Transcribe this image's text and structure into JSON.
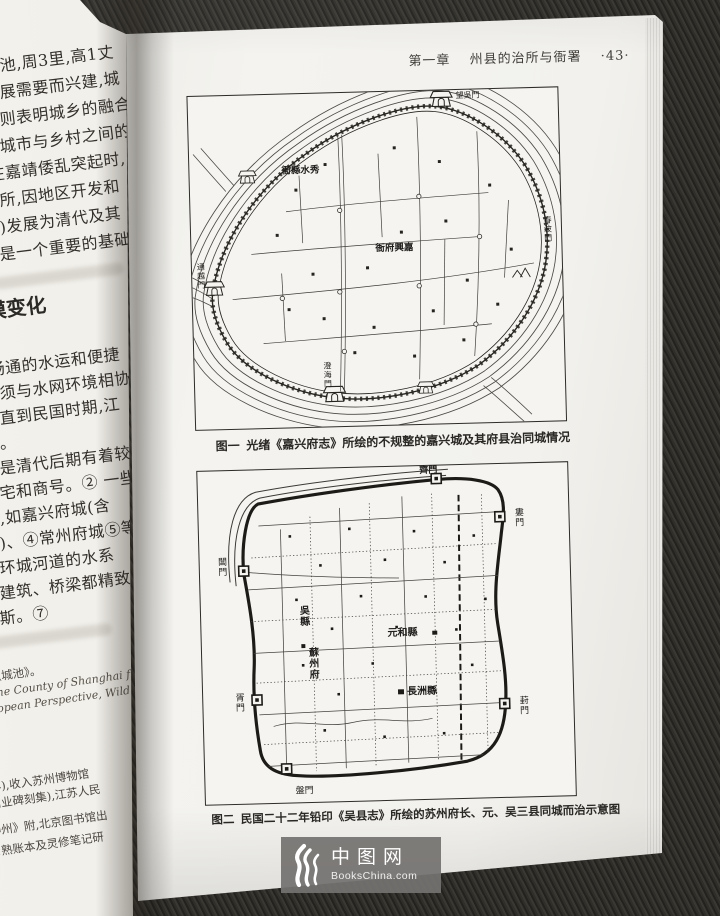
{
  "page": {
    "header": {
      "chapter": "第一章",
      "title": "州县的治所与衙署",
      "page_no": "·43·"
    },
    "figure1": {
      "tag": "图一",
      "caption": "光绪《嘉兴府志》所绘的不规整的嘉兴城及其府县治同城情况",
      "labels": {
        "xiushui_yamen": "衙縣水秀",
        "jiaxing_yamen": "衙府興嘉",
        "gate_north": "望吳門",
        "gate_west": "通越門",
        "gate_east": "春波門",
        "gate_south": "澄海門"
      }
    },
    "figure2": {
      "tag": "图二",
      "caption": "民国二十二年铅印《吴县志》所绘的苏州府长、元、吴三县同城而治示意图",
      "labels": {
        "gate_north": "齊門",
        "gate_northeast": "婁門",
        "gate_east": "葑門",
        "gate_south": "盤門",
        "gate_southwest": "胥門",
        "gate_west": "閶門",
        "wu_county": "吳縣",
        "suzhou_fu": "蘇州府",
        "yuanhe_county": "元和縣",
        "changzhou_county": "長洲縣"
      }
    }
  },
  "left_page": {
    "para1_lines": [
      "筑城池,周3里,高1丈",
      "的发展需要而兴建,城",
      "方面则表明城乡的融合",
      "和大城市与乡村之间的",
      "性,在嘉靖倭乱突起时,",
      "政驻所,因地区开发和",
      "卫等)发展为清代及其",
      "应当是一个重要的基础"
    ],
    "heading": "模变化",
    "para2_lines": [
      "上,畅通的水运和便捷",
      "态必须与水网环境相协",
      "况。直到民国时期,江",
      "一致。",
      "即便是清代后期有着较",
      "户住宅和商号。② 一些",
      "要求,如嘉兴府城(含",
      "附郭)、④常州府城⑤等",
      "一条环城河道的水系",
      "城内建筑、桥梁都精致",
      "威尼斯。⑦"
    ],
    "footnote_lines": [
      {
        "text": "十九《城池》。",
        "style": "cjk"
      },
      {
        "text": "ays: the County of Shanghai fr",
        "style": "en"
      },
      {
        "text": "a European Perspective, Wild",
        "style": "en"
      },
      {
        "text": "刻本。",
        "style": "cjk"
      },
      {
        "text": "庆二年),收入苏州博物馆",
        "style": "cjk"
      },
      {
        "text": "州工商业碑刻集),江苏人民",
        "style": "cjk"
      },
      {
        "text": "督话神州》附,北京图书馆出",
        "style": "cjk"
      },
      {
        "text": "日满常熟账本及灵修笔记研",
        "style": "cjk"
      }
    ]
  },
  "watermark": {
    "brand": "中图网",
    "domain": "BooksChina.com"
  }
}
